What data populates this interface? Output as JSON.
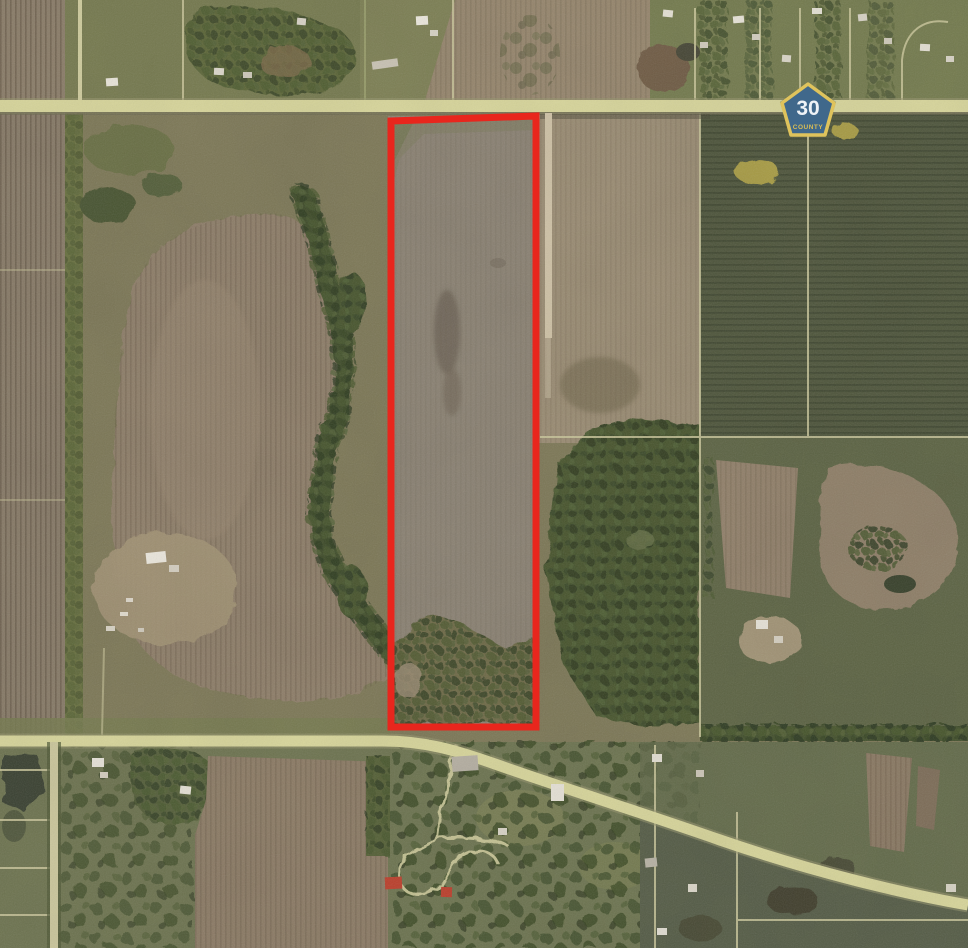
{
  "map": {
    "type": "aerial-parcel-map",
    "route_marker": {
      "number": "30",
      "label": "COUNTY",
      "fill": "#40688b",
      "border": "#dfc35c",
      "number_color": "#eef2f6",
      "label_color": "#d9bd55"
    },
    "parcel_outline": {
      "color": "#e8261d",
      "points": "391,121 536,116 536,727 391,727",
      "stroke_width": 7
    },
    "roads": {
      "surface_color": "#d8d69b",
      "shoulder_color": "#98956d",
      "dirt_track_color": "#cfc2a6"
    },
    "terrain": {
      "tilled_parcel_field": "#8b8273",
      "plowed_brown_field": "#8e7e69",
      "crop_field_green": "#4f563c",
      "woodland_green": "#46542f",
      "grass_green": "#6d7450",
      "pond": "#3b4333",
      "yellow_crop_patch": "#a89c44"
    }
  }
}
